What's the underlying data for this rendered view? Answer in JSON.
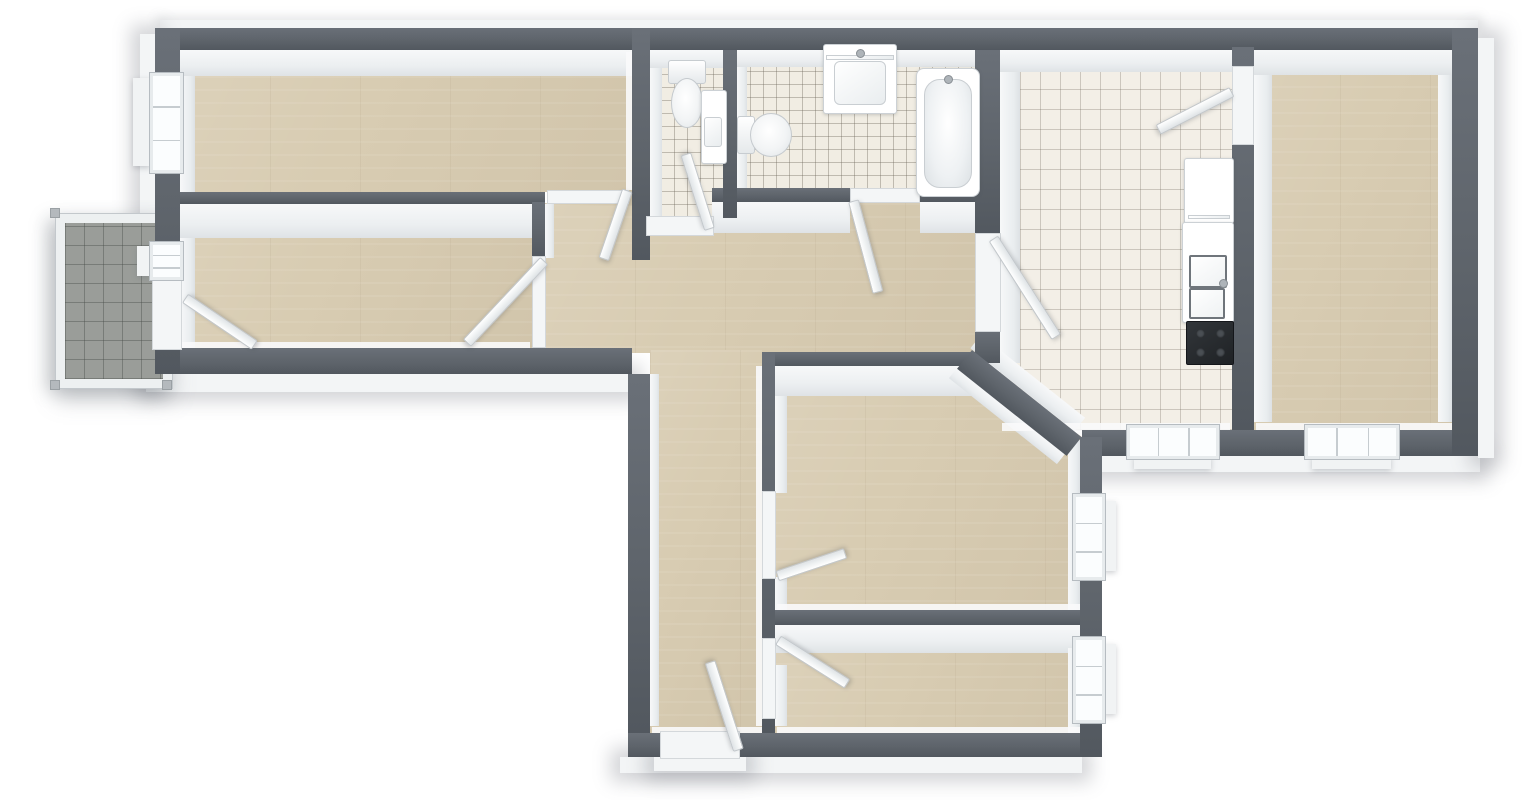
{
  "meta": {
    "title": "3D apartment floor plan (top-down render)",
    "canvas_w": 1531,
    "canvas_h": 800
  },
  "palette": {
    "wall": "#5e646b",
    "wall-hi": "#6a7078",
    "wall-lo": "#52585f",
    "wood": "#d8ccb2",
    "tile": "#f1ede3",
    "ktile": "#f3efe7",
    "balc": "#9a9d99",
    "fixture": "#ffffff",
    "cooktop": "#26292d"
  },
  "scene": {
    "outer_faces": [
      {
        "n": "outer-face-left",
        "r": [
          140,
          34,
          15,
          342
        ]
      },
      {
        "n": "outer-face-room2-south",
        "r": [
          146,
          374,
          486,
          18
        ]
      },
      {
        "n": "outer-face-bottom",
        "r": [
          620,
          757,
          462,
          16
        ]
      },
      {
        "n": "outer-face-kitchen-south",
        "r": [
          1078,
          456,
          402,
          16
        ]
      },
      {
        "n": "outer-face-right",
        "r": [
          1478,
          38,
          16,
          420
        ]
      },
      {
        "n": "entry-step",
        "r": [
          654,
          757,
          92,
          14
        ]
      }
    ],
    "top_face": [
      {
        "n": "outer-face-top",
        "r": [
          160,
          20,
          1318,
          8
        ]
      }
    ],
    "floors": [
      {
        "n": "floor-bedroom-1",
        "k": "wood",
        "r": [
          180,
          50,
          452,
          142
        ]
      },
      {
        "n": "floor-room-2",
        "k": "wood",
        "r": [
          180,
          204,
          352,
          144
        ]
      },
      {
        "n": "floor-corridor",
        "k": "wood",
        "r": [
          545,
          203,
          430,
          150
        ]
      },
      {
        "n": "floor-hallway",
        "k": "wood",
        "r": [
          650,
          350,
          112,
          385
        ]
      },
      {
        "n": "floor-doorway-bedroom-1",
        "k": "wood",
        "r": [
          547,
          192,
          85,
          14
        ]
      },
      {
        "n": "floor-living-room",
        "k": "wood",
        "r": [
          775,
          366,
          307,
          244
        ],
        "clip": "polygon(0 0,202px 0,100% 71px,100% 100%,0 100%)"
      },
      {
        "n": "floor-bottom-room",
        "k": "wood",
        "r": [
          775,
          637,
          307,
          98
        ]
      },
      {
        "n": "floor-bedroom-2",
        "k": "wood",
        "r": [
          1250,
          47,
          202,
          383
        ]
      },
      {
        "n": "floor-bathroom",
        "k": "tile-s",
        "r": [
          737,
          50,
          238,
          152
        ]
      },
      {
        "n": "floor-wc",
        "k": "tile-s",
        "r": [
          648,
          50,
          77,
          168
        ]
      },
      {
        "n": "floor-kitchen",
        "k": "tile-l",
        "r": [
          1000,
          70,
          232,
          360
        ],
        "clip": "polygon(0 0,100% 0,100% 100%,73px 100%,0 302px)"
      }
    ],
    "inner_faces": [
      {
        "n": "face-top-bedroom-1",
        "r": [
          180,
          50,
          452,
          26
        ],
        "v": false
      },
      {
        "n": "face-top-wc",
        "r": [
          650,
          50,
          73,
          18
        ],
        "v": false
      },
      {
        "n": "face-top-bathroom",
        "r": [
          737,
          50,
          238,
          17
        ],
        "v": false
      },
      {
        "n": "face-top-kitchen",
        "r": [
          1000,
          50,
          232,
          22
        ],
        "v": false
      },
      {
        "n": "face-top-bedroom-2",
        "r": [
          1254,
          47,
          198,
          28
        ],
        "v": false
      },
      {
        "n": "face-room2-north",
        "r": [
          180,
          204,
          352,
          34
        ],
        "v": false
      },
      {
        "n": "face-corridor-bath-1",
        "r": [
          712,
          202,
          138,
          31
        ],
        "v": false
      },
      {
        "n": "face-corridor-bath-2",
        "r": [
          920,
          202,
          60,
          31
        ],
        "v": false
      },
      {
        "n": "face-living-north",
        "r": [
          775,
          366,
          202,
          30
        ],
        "v": false
      },
      {
        "n": "face-bottomroom-north",
        "r": [
          775,
          625,
          307,
          28
        ],
        "v": false
      },
      {
        "n": "face-left-bedroom-1",
        "r": [
          180,
          76,
          15,
          116
        ],
        "v": true
      },
      {
        "n": "face-left-room-2",
        "r": [
          180,
          238,
          15,
          110
        ],
        "v": true
      },
      {
        "n": "face-wc-west",
        "r": [
          650,
          68,
          12,
          148
        ],
        "v": true
      },
      {
        "n": "face-bath-west",
        "r": [
          737,
          67,
          10,
          121
        ],
        "v": true
      },
      {
        "n": "face-kitchen-west",
        "r": [
          1000,
          72,
          20,
          291
        ],
        "v": true
      },
      {
        "n": "face-bedroom2-west",
        "r": [
          1254,
          75,
          18,
          347
        ],
        "v": true
      },
      {
        "n": "face-bedroom2-east",
        "r": [
          1438,
          75,
          14,
          347
        ],
        "v": true
      },
      {
        "n": "face-living-west-a",
        "r": [
          775,
          396,
          12,
          97
        ],
        "v": true
      },
      {
        "n": "face-living-west-b",
        "r": [
          775,
          577,
          12,
          33
        ],
        "v": true
      },
      {
        "n": "face-bottomroom-west",
        "r": [
          775,
          665,
          12,
          61
        ],
        "v": true
      },
      {
        "n": "face-living-east",
        "r": [
          1068,
          440,
          12,
          170
        ],
        "v": true
      },
      {
        "n": "face-bottomroom-east",
        "r": [
          1068,
          648,
          12,
          100
        ],
        "v": true
      },
      {
        "n": "face-room2-doorjamb",
        "r": [
          545,
          204,
          9,
          54
        ],
        "v": true
      },
      {
        "n": "face-hallway-west",
        "r": [
          650,
          374,
          9,
          352
        ],
        "v": true
      }
    ],
    "rot_faces": [
      {
        "n": "face-diagonal-kitchen",
        "r": [
          981,
          335,
          133,
          17
        ],
        "a": 38.5
      },
      {
        "n": "face-diagonal-living",
        "r": [
          957,
          368,
          138,
          13
        ],
        "a": 38.5
      }
    ],
    "baseboards": [
      {
        "n": "baseboard-room2-south",
        "r": [
          182,
          342,
          348,
          7
        ]
      },
      {
        "n": "baseboard-hallway-south",
        "r": [
          652,
          727,
          110,
          7
        ]
      },
      {
        "n": "baseboard-bottomroom-south",
        "r": [
          777,
          727,
          303,
          7
        ]
      },
      {
        "n": "baseboard-kitchen-south",
        "r": [
          1002,
          423,
          228,
          8
        ]
      },
      {
        "n": "baseboard-bedroom2-south",
        "r": [
          1256,
          423,
          196,
          8
        ]
      },
      {
        "n": "baseboard-living-south",
        "r": [
          777,
          604,
          303,
          7
        ]
      },
      {
        "n": "baseboard-bedroom1-east",
        "r": [
          626,
          52,
          6,
          138
        ]
      },
      {
        "n": "baseboard-corridor-east",
        "r": [
          756,
          366,
          6,
          360
        ]
      }
    ],
    "walls": [
      {
        "n": "wall-top",
        "r": [
          155,
          28,
          1323,
          22
        ]
      },
      {
        "n": "wall-bedroom1-room2",
        "r": [
          155,
          192,
          390,
          12
        ]
      },
      {
        "n": "wall-bath-south-left",
        "r": [
          712,
          188,
          138,
          14
        ]
      },
      {
        "n": "wall-bath-south-right",
        "r": [
          920,
          188,
          55,
          14
        ]
      },
      {
        "n": "wall-room2-south",
        "r": [
          155,
          348,
          477,
          26
        ]
      },
      {
        "n": "wall-living-north",
        "r": [
          762,
          352,
          218,
          14
        ]
      },
      {
        "n": "wall-living-bottomroom",
        "r": [
          775,
          610,
          307,
          15
        ]
      },
      {
        "n": "wall-kitchen-south",
        "r": [
          1082,
          430,
          396,
          26
        ]
      },
      {
        "n": "wall-bottom",
        "r": [
          628,
          733,
          454,
          24
        ]
      },
      {
        "n": "wall-left",
        "r": [
          155,
          28,
          25,
          346
        ]
      },
      {
        "n": "wall-bedroom1-wc",
        "r": [
          632,
          28,
          18,
          232
        ]
      },
      {
        "n": "wall-wc-bath",
        "r": [
          723,
          50,
          14,
          168
        ]
      },
      {
        "n": "wall-bath-kitchen",
        "r": [
          975,
          50,
          25,
          185
        ]
      },
      {
        "n": "wall-kitchen-west-stub",
        "r": [
          975,
          330,
          25,
          33
        ]
      },
      {
        "n": "wall-hallway-west",
        "r": [
          628,
          374,
          22,
          359
        ]
      },
      {
        "n": "wall-hallway-east",
        "r": [
          762,
          352,
          13,
          381
        ]
      },
      {
        "n": "wall-kitchen-bedroom2",
        "r": [
          1232,
          47,
          22,
          383
        ]
      },
      {
        "n": "wall-bottomrooms-east",
        "r": [
          1080,
          437,
          22,
          320
        ]
      },
      {
        "n": "wall-right",
        "r": [
          1452,
          28,
          26,
          428
        ]
      },
      {
        "n": "wall-room2-doorjamb",
        "r": [
          532,
          202,
          13,
          56
        ]
      }
    ],
    "rot_walls": [
      {
        "n": "wall-diagonal",
        "r": [
          972,
          350,
          140,
          24
        ],
        "a": 38.5
      }
    ],
    "thresholds": [
      {
        "n": "threshold-bedroom-1",
        "r": [
          547,
          190,
          82,
          14
        ]
      },
      {
        "n": "threshold-room-2",
        "r": [
          532,
          256,
          14,
          92
        ]
      },
      {
        "n": "threshold-balcony-door",
        "r": [
          152,
          276,
          30,
          74
        ]
      },
      {
        "n": "threshold-wc",
        "r": [
          646,
          216,
          68,
          20
        ]
      },
      {
        "n": "threshold-bathroom",
        "r": [
          850,
          188,
          70,
          15
        ]
      },
      {
        "n": "threshold-kitchen",
        "r": [
          975,
          233,
          26,
          99
        ]
      },
      {
        "n": "threshold-kitchen-bedroom2",
        "r": [
          1232,
          66,
          22,
          79
        ]
      },
      {
        "n": "threshold-living-room",
        "r": [
          762,
          491,
          14,
          88
        ]
      },
      {
        "n": "threshold-bottom-room",
        "r": [
          762,
          638,
          14,
          81
        ]
      },
      {
        "n": "threshold-entrance",
        "r": [
          660,
          731,
          80,
          28
        ]
      }
    ],
    "windows": [
      {
        "n": "window-bedroom-1",
        "r": [
          149,
          72,
          33,
          100
        ],
        "o": "v"
      },
      {
        "n": "window-room-2",
        "r": [
          149,
          241,
          33,
          38
        ],
        "o": "v"
      },
      {
        "n": "window-kitchen",
        "r": [
          1126,
          424,
          92,
          34
        ],
        "o": "h"
      },
      {
        "n": "window-bedroom-2",
        "r": [
          1304,
          424,
          94,
          34
        ],
        "o": "h"
      },
      {
        "n": "window-living-room",
        "r": [
          1072,
          493,
          32,
          86
        ],
        "o": "v"
      },
      {
        "n": "window-bottom-room",
        "r": [
          1072,
          636,
          32,
          86
        ],
        "o": "v"
      }
    ],
    "sills": [
      {
        "n": "sill-bedroom-1",
        "r": [
          133,
          78,
          17,
          88
        ]
      },
      {
        "n": "sill-room-2",
        "r": [
          137,
          246,
          13,
          30
        ]
      },
      {
        "n": "sill-kitchen",
        "r": [
          1134,
          456,
          77,
          13
        ]
      },
      {
        "n": "sill-bedroom-2",
        "r": [
          1312,
          456,
          79,
          13
        ]
      },
      {
        "n": "sill-living-room",
        "r": [
          1102,
          501,
          14,
          70
        ]
      },
      {
        "n": "sill-bottom-room",
        "r": [
          1102,
          644,
          14,
          70
        ]
      }
    ],
    "doors": [
      {
        "n": "door-bedroom-1",
        "s": [
          626,
          190
        ],
        "e": [
          603,
          257
        ]
      },
      {
        "n": "door-room-2",
        "s": [
          543,
          260
        ],
        "e": [
          467,
          341
        ]
      },
      {
        "n": "door-balcony",
        "s": [
          184,
          299
        ],
        "e": [
          252,
          345
        ]
      },
      {
        "n": "door-wc",
        "s": [
          710,
          229
        ],
        "e": [
          687,
          156
        ]
      },
      {
        "n": "door-bathroom",
        "s": [
          852,
          201
        ],
        "e": [
          876,
          291
        ]
      },
      {
        "n": "door-kitchen",
        "s": [
          992,
          239
        ],
        "e": [
          1054,
          336
        ]
      },
      {
        "n": "door-kitchen-bedroom2",
        "s": [
          1231,
          91
        ],
        "e": [
          1159,
          128
        ]
      },
      {
        "n": "door-living-room",
        "s": [
          777,
          577
        ],
        "e": [
          843,
          555
        ]
      },
      {
        "n": "door-bottom-room",
        "s": [
          777,
          641
        ],
        "e": [
          845,
          684
        ]
      },
      {
        "n": "door-entrance",
        "s": [
          739,
          750
        ],
        "e": [
          711,
          663
        ]
      }
    ],
    "fixtures": [
      {
        "n": "toilet-wc",
        "t": "toilet-v",
        "r": [
          668,
          60,
          36,
          68
        ]
      },
      {
        "n": "corner-sink-wc",
        "t": "corner-sink",
        "r": [
          701,
          90,
          24,
          72
        ]
      },
      {
        "n": "toilet-bathroom",
        "t": "toilet-h",
        "r": [
          737,
          112,
          54,
          44
        ]
      },
      {
        "n": "washbasin-vanity",
        "t": "vanity",
        "r": [
          823,
          44,
          72,
          68
        ]
      },
      {
        "n": "bathtub",
        "t": "bathtub",
        "r": [
          916,
          68,
          62,
          127
        ]
      },
      {
        "n": "kitchen-cabinet",
        "t": "cabinet",
        "r": [
          1184,
          158,
          48,
          64
        ]
      },
      {
        "n": "kitchen-sink-counter",
        "t": "counter-sink",
        "r": [
          1182,
          222,
          50,
          99
        ]
      },
      {
        "n": "kitchen-cooktop",
        "t": "cooktop",
        "r": [
          1186,
          321,
          46,
          42
        ]
      }
    ],
    "balcony": {
      "frame": [
        56,
        214,
        118,
        176
      ],
      "posts": [
        [
          50,
          208
        ],
        [
          162,
          208
        ],
        [
          50,
          380
        ],
        [
          162,
          380
        ]
      ]
    }
  }
}
